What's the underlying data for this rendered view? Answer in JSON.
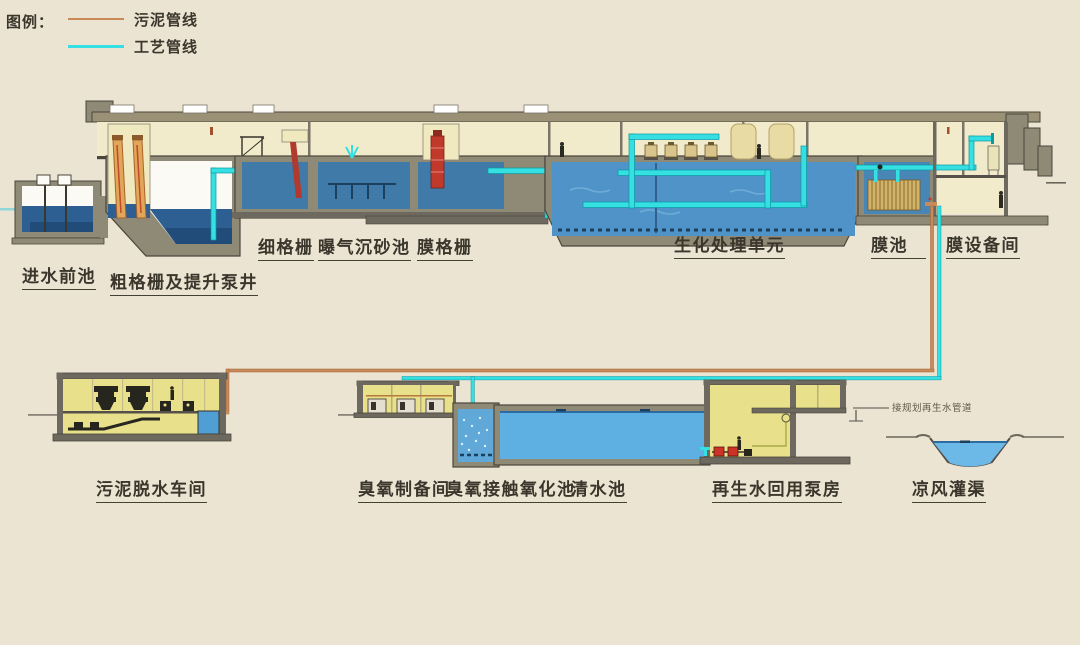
{
  "legend": {
    "title": "图例：",
    "items": [
      {
        "name": "sludge-pipeline",
        "label": "污泥管线",
        "color": "#c98a58"
      },
      {
        "name": "process-pipeline",
        "label": "工艺管线",
        "color": "#35dfe2"
      }
    ]
  },
  "labels": [
    {
      "id": "inlet-forebay",
      "text": "进水前池"
    },
    {
      "id": "coarse-screen-and-lift-pump-well",
      "text": "粗格栅及提升泵井"
    },
    {
      "id": "fine-screen",
      "text": "细格栅"
    },
    {
      "id": "aerated-grit-chamber",
      "text": "曝气沉砂池"
    },
    {
      "id": "membrane-screen",
      "text": "膜格栅"
    },
    {
      "id": "biological-treatment-unit",
      "text": "生化处理单元"
    },
    {
      "id": "membrane-tank",
      "text": "膜池"
    },
    {
      "id": "membrane-equipment-room",
      "text": "膜设备间"
    },
    {
      "id": "sludge-dewatering-workshop",
      "text": "污泥脱水车间"
    },
    {
      "id": "ozone-preparation-room",
      "text": "臭氧制备间"
    },
    {
      "id": "ozone-contact-oxidation-tank",
      "text": "臭氧接触氧化池"
    },
    {
      "id": "clear-water-tank",
      "text": "清水池"
    },
    {
      "id": "reclaimed-water-reuse-pump-house",
      "text": "再生水回用泵房"
    },
    {
      "id": "liangfeng-irrigation-channel",
      "text": "凉风灌渠"
    }
  ],
  "annotations": [
    {
      "id": "planned-reclaimed-water-pipeline",
      "text": "接规划再生水管道"
    }
  ],
  "colors": {
    "background": "#ece4d2",
    "wall": "#8f8a76",
    "wall_dark": "#4a463c",
    "slab": "#6e695e",
    "interior_cream": "#f2ebcb",
    "interior_yellow": "#e9e08b",
    "water_dark": "#2d5f93",
    "water_medium": "#4f93c8",
    "water_light": "#5fb0e2",
    "pipe_process": "#35dfe2",
    "pipe_sludge": "#c98a58",
    "equipment_red": "#c0392b",
    "screen_orange": "#e2a658"
  }
}
